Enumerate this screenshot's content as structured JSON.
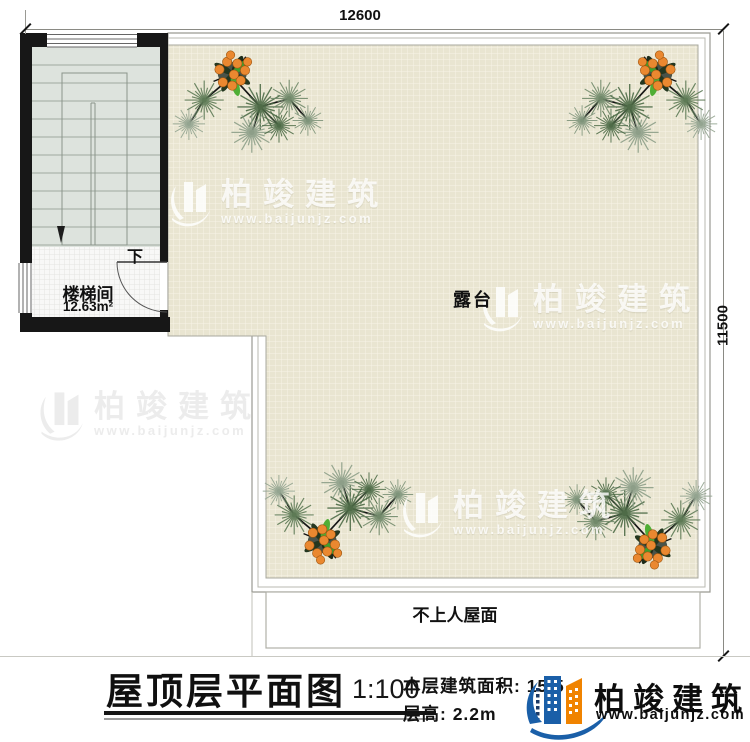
{
  "drawing": {
    "dimensions": {
      "top": "12600",
      "right": "11500"
    },
    "stair_room": {
      "name": "楼梯间",
      "area": "12.63m²",
      "direction_label": "下"
    },
    "terrace": {
      "label": "露台"
    },
    "lower_roof": {
      "label": "不上人屋面"
    }
  },
  "title_block": {
    "title": "屋顶层平面图",
    "scale": "1:100",
    "floor_area_label": "本层建筑面积:",
    "floor_area_value": "15.5",
    "floor_height_label": "层高:",
    "floor_height_value": "2.2m"
  },
  "brand": {
    "name": "柏竣建筑",
    "website": "www.baijunjz.com"
  },
  "watermark": {
    "name": "柏竣建筑",
    "website": "www.baijunjz.com"
  },
  "colors": {
    "terrace_fill": "#e9e5d1",
    "terrace_grid": "#f7f4e6",
    "wall": "#171717",
    "stair_fill": "#dde3dd",
    "logo_blue": "#1a5fa8",
    "logo_orange": "#f08300",
    "pine_green": "#4e6b47",
    "fruit_orange": "#ea8830"
  }
}
